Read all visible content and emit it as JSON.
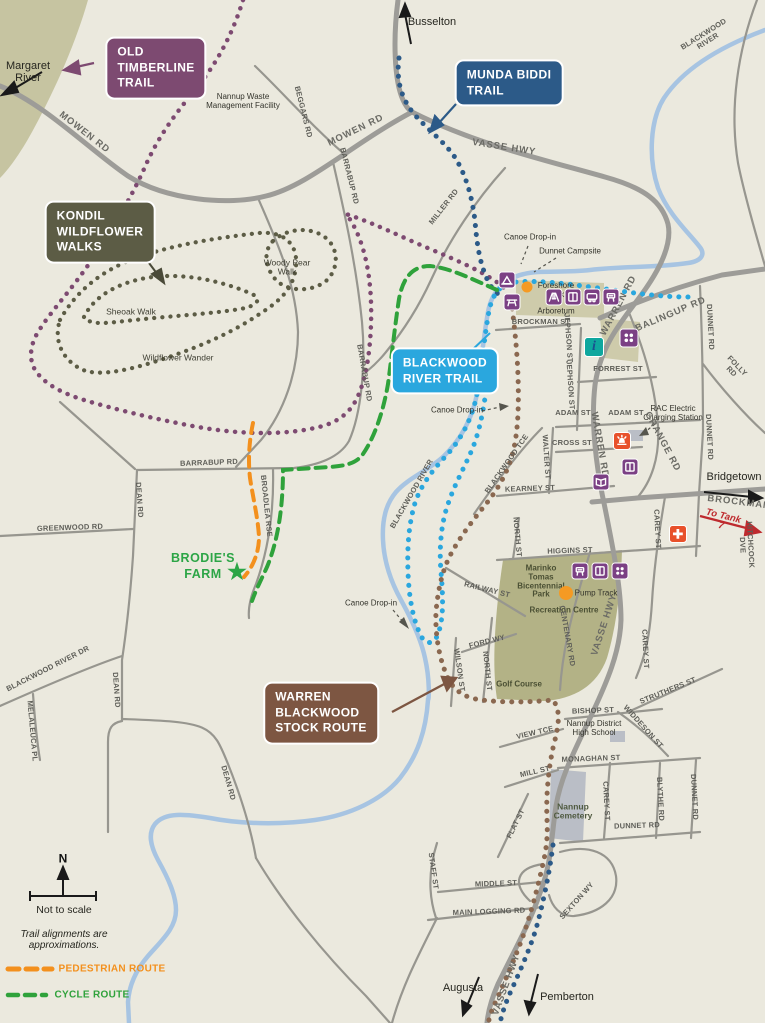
{
  "map_title": "Nannup trails map",
  "colors": {
    "background": "#EBE9DE",
    "forest": "#C6C4A1",
    "park": "#B3B286",
    "river": "#A7C4E2",
    "road": "#9D9C98",
    "old_timberline": "#7D4A71",
    "munda_biddi": "#2C5A88",
    "kondil": "#5C5C45",
    "blackwood_trail": "#2AA7DE",
    "stock_route": "#8A6850",
    "pedestrian": "#F3901D",
    "cycle": "#2FA23B",
    "facility": "#7B4084",
    "emergency": "#E8512B",
    "info": "#0FA79E",
    "marker": "#F59A23"
  },
  "callouts": [
    {
      "n": "old-timberline-trail-callout",
      "t": "OLD\nTIMBERLINE\nTRAIL",
      "x": 156,
      "y": 68,
      "bg": "#7D4A71"
    },
    {
      "n": "munda-biddi-trail-callout",
      "t": "MUNDA BIDDI\nTRAIL",
      "x": 509,
      "y": 83,
      "bg": "#2C5A88"
    },
    {
      "n": "kondil-wildflower-walks-callout",
      "t": "KONDIL\nWILDFLOWER\nWALKS",
      "x": 100,
      "y": 232,
      "bg": "#5C5C45"
    },
    {
      "n": "blackwood-river-trail-callout",
      "t": "BLACKWOOD\nRIVER TRAIL",
      "x": 445,
      "y": 371,
      "bg": "#2AA7DE"
    },
    {
      "n": "warren-blackwood-stock-route-callout",
      "t": "WARREN\nBLACKWOOD\nSTOCK ROUTE",
      "x": 321,
      "y": 713,
      "bg": "#7D5642"
    }
  ],
  "labels": [
    {
      "n": "margaret-river-label",
      "t": "Margaret\nRiver",
      "x": 28,
      "y": 72,
      "r": 0,
      "c": "pl"
    },
    {
      "n": "busselton-label",
      "t": "Busselton",
      "x": 432,
      "y": 22,
      "r": 0,
      "c": "pl"
    },
    {
      "n": "nannup-waste-management-facility-label",
      "t": "Nannup Waste\nManagement Facility",
      "x": 243,
      "y": 102,
      "r": 0,
      "c": "poi"
    },
    {
      "n": "beggars-rd-label",
      "t": "BEGGARS RD",
      "x": 303,
      "y": 112,
      "r": 76,
      "c": "rd"
    },
    {
      "n": "mowen-rd-west-label",
      "t": "MOWEN RD",
      "x": 84,
      "y": 133,
      "r": 38,
      "c": "rdl"
    },
    {
      "n": "mowen-rd-east-label",
      "t": "MOWEN RD",
      "x": 356,
      "y": 131,
      "r": -26,
      "c": "rdl"
    },
    {
      "n": "vasse-hwy-north-label",
      "t": "VASSE HWY",
      "x": 504,
      "y": 148,
      "r": 9,
      "c": "rdl"
    },
    {
      "n": "blackwood-river-north-label",
      "t": "BLACKWOOD RIVER",
      "x": 706,
      "y": 38,
      "r": -32,
      "c": "rd"
    },
    {
      "n": "miller-rd-label",
      "t": "MILLER RD",
      "x": 444,
      "y": 207,
      "r": -52,
      "c": "rd"
    },
    {
      "n": "barrabup-rd-north-label",
      "t": "BARRABUP RD",
      "x": 349,
      "y": 176,
      "r": 76,
      "c": "rd"
    },
    {
      "n": "barrabup-rd-mid-label",
      "t": "BARRABUP RD",
      "x": 364,
      "y": 373,
      "r": 80,
      "c": "rd"
    },
    {
      "n": "barrabup-rd-west-label",
      "t": "BARRABUP RD",
      "x": 209,
      "y": 463,
      "r": -2,
      "c": "rd"
    },
    {
      "n": "woody-pear-walk-label",
      "t": "Woody Pear\nWalk",
      "x": 287,
      "y": 268,
      "r": 0,
      "c": "walk"
    },
    {
      "n": "sheoak-walk-label",
      "t": "Sheoak Walk",
      "x": 131,
      "y": 312,
      "r": 0,
      "c": "walk"
    },
    {
      "n": "wildflower-wander-label",
      "t": "Wildflower Wander",
      "x": 178,
      "y": 358,
      "r": 0,
      "c": "walk"
    },
    {
      "n": "canoe-drop-in-north-label",
      "t": "Canoe Drop-in",
      "x": 530,
      "y": 238,
      "r": 0,
      "c": "poi"
    },
    {
      "n": "dunnet-campsite-label",
      "t": "Dunnet Campsite",
      "x": 570,
      "y": 252,
      "r": 0,
      "c": "poi"
    },
    {
      "n": "foreshore-park-label",
      "t": "Foreshore\nPark",
      "x": 556,
      "y": 291,
      "r": 0,
      "c": "poi"
    },
    {
      "n": "arboretum-label",
      "t": "Arboretum",
      "x": 556,
      "y": 312,
      "r": 0,
      "c": "poi"
    },
    {
      "n": "brockman-st-label",
      "t": "BROCKMAN ST",
      "x": 541,
      "y": 322,
      "r": 0,
      "c": "rd"
    },
    {
      "n": "jephson-st-north-label",
      "t": "JEPHSON ST",
      "x": 568,
      "y": 338,
      "r": 86,
      "c": "rd"
    },
    {
      "n": "jephson-st-south-label",
      "t": "JEPHSON ST",
      "x": 570,
      "y": 385,
      "r": 86,
      "c": "rd"
    },
    {
      "n": "warren-rd-north-label",
      "t": "WARREN RD",
      "x": 619,
      "y": 306,
      "r": -62,
      "c": "rdl"
    },
    {
      "n": "warren-rd-mid-label",
      "t": "WARREN RD",
      "x": 599,
      "y": 445,
      "r": 80,
      "c": "rdl"
    },
    {
      "n": "balingup-rd-label",
      "t": "BALINGUP RD",
      "x": 671,
      "y": 315,
      "r": -23,
      "c": "rdl"
    },
    {
      "n": "dunnet-rd-north-label",
      "t": "DUNNET RD",
      "x": 710,
      "y": 327,
      "r": 87,
      "c": "rd"
    },
    {
      "n": "dunnet-rd-mid-label",
      "t": "DUNNET RD",
      "x": 709,
      "y": 437,
      "r": 87,
      "c": "rd"
    },
    {
      "n": "folly-rd-label",
      "t": "FOLLY RD",
      "x": 734,
      "y": 369,
      "r": 46,
      "c": "rd"
    },
    {
      "n": "forrest-st-label",
      "t": "FORREST ST",
      "x": 618,
      "y": 369,
      "r": 0,
      "c": "rd"
    },
    {
      "n": "rac-charging-label",
      "t": "RAC Electric\nCharging Station",
      "x": 673,
      "y": 414,
      "r": 0,
      "c": "poi"
    },
    {
      "n": "adam-st-west-label",
      "t": "ADAM ST",
      "x": 573,
      "y": 413,
      "r": 0,
      "c": "rd"
    },
    {
      "n": "adam-st-east-label",
      "t": "ADAM ST",
      "x": 626,
      "y": 413,
      "r": 0,
      "c": "rd"
    },
    {
      "n": "cross-st-label",
      "t": "CROSS ST",
      "x": 572,
      "y": 443,
      "r": 0,
      "c": "rd"
    },
    {
      "n": "walter-st-label",
      "t": "WALTER ST",
      "x": 546,
      "y": 457,
      "r": 86,
      "c": "rd"
    },
    {
      "n": "grange-rd-label",
      "t": "GRANGE RD",
      "x": 662,
      "y": 442,
      "r": 62,
      "c": "rdl"
    },
    {
      "n": "bridgetown-label",
      "t": "Bridgetown",
      "x": 734,
      "y": 477,
      "r": 0,
      "c": "pl"
    },
    {
      "n": "brockman-east-label",
      "t": "BROCKMAN",
      "x": 739,
      "y": 503,
      "r": 7,
      "c": "rdl"
    },
    {
      "n": "to-tank-7-label",
      "t": "To Tank 7",
      "x": 722,
      "y": 522,
      "r": 14,
      "c": "tank"
    },
    {
      "n": "hitchcock-dve-label",
      "t": "HITCHCOCK DVE",
      "x": 746,
      "y": 545,
      "r": 87,
      "c": "rd"
    },
    {
      "n": "kearney-st-label",
      "t": "KEARNEY ST",
      "x": 530,
      "y": 489,
      "r": -2,
      "c": "rd"
    },
    {
      "n": "blackwood-tce-label",
      "t": "BLACKWOOD TCE",
      "x": 507,
      "y": 464,
      "r": -55,
      "c": "rd"
    },
    {
      "n": "blackwood-river-mid-label",
      "t": "BLACKWOOD RIVER",
      "x": 412,
      "y": 494,
      "r": -60,
      "c": "rd"
    },
    {
      "n": "canoe-drop-in-mid-label",
      "t": "Canoe Drop-in",
      "x": 457,
      "y": 411,
      "r": 0,
      "c": "poi"
    },
    {
      "n": "higgins-st-label",
      "t": "HIGGINS ST",
      "x": 570,
      "y": 551,
      "r": -2,
      "c": "rd"
    },
    {
      "n": "north-st-north-label",
      "t": "NORTH ST",
      "x": 517,
      "y": 537,
      "r": 85,
      "c": "rd"
    },
    {
      "n": "marinko-park-label",
      "t": "Marinko\nTomas\nBicentennial\nPark",
      "x": 541,
      "y": 582,
      "r": 0,
      "c": "po"
    },
    {
      "n": "pump-track-label",
      "t": "Pump Track",
      "x": 596,
      "y": 594,
      "r": 0,
      "c": "poi"
    },
    {
      "n": "recreation-centre-label",
      "t": "Recreation Centre",
      "x": 564,
      "y": 611,
      "r": 0,
      "c": "po"
    },
    {
      "n": "centenary-rd-label",
      "t": "CENTENARY RD",
      "x": 567,
      "y": 636,
      "r": 80,
      "c": "rd"
    },
    {
      "n": "vasse-hwy-mid-label",
      "t": "VASSE HWY",
      "x": 605,
      "y": 625,
      "r": -72,
      "c": "rdl"
    },
    {
      "n": "ford-wy-label",
      "t": "FORD WY",
      "x": 487,
      "y": 642,
      "r": -14,
      "c": "rd"
    },
    {
      "n": "wilson-st-label",
      "t": "WILSON ST",
      "x": 459,
      "y": 670,
      "r": 82,
      "c": "rd"
    },
    {
      "n": "north-st-south-label",
      "t": "NORTH ST",
      "x": 487,
      "y": 671,
      "r": 84,
      "c": "rd"
    },
    {
      "n": "railway-st-label",
      "t": "RAILWAY ST",
      "x": 487,
      "y": 590,
      "r": 14,
      "c": "rd"
    },
    {
      "n": "carey-st-north-label",
      "t": "CAREY ST",
      "x": 657,
      "y": 529,
      "r": 87,
      "c": "rd"
    },
    {
      "n": "carey-st-mid-label",
      "t": "CAREY ST",
      "x": 645,
      "y": 649,
      "r": 87,
      "c": "rd"
    },
    {
      "n": "golf-course-label",
      "t": "Golf Course",
      "x": 519,
      "y": 685,
      "r": 0,
      "c": "po"
    },
    {
      "n": "struthers-st-label",
      "t": "STRUTHERS ST",
      "x": 668,
      "y": 691,
      "r": -22,
      "c": "rd"
    },
    {
      "n": "bishop-st-label",
      "t": "BISHOP ST",
      "x": 593,
      "y": 711,
      "r": -2,
      "c": "rd"
    },
    {
      "n": "widdeson-st-label",
      "t": "WIDDESON ST",
      "x": 643,
      "y": 727,
      "r": 48,
      "c": "rd"
    },
    {
      "n": "nannup-high-school-label",
      "t": "Nannup District\nHigh School",
      "x": 594,
      "y": 729,
      "r": 0,
      "c": "poi"
    },
    {
      "n": "view-tce-label",
      "t": "VIEW TCE",
      "x": 535,
      "y": 733,
      "r": -13,
      "c": "rd"
    },
    {
      "n": "monaghan-st-label",
      "t": "MONAGHAN ST",
      "x": 591,
      "y": 759,
      "r": -2,
      "c": "rd"
    },
    {
      "n": "mill-st-label",
      "t": "MILL ST",
      "x": 535,
      "y": 772,
      "r": -13,
      "c": "rd"
    },
    {
      "n": "carey-st-south-label",
      "t": "CAREY ST",
      "x": 606,
      "y": 801,
      "r": 87,
      "c": "rd"
    },
    {
      "n": "blythe-rd-label",
      "t": "BLYTHE RD",
      "x": 660,
      "y": 799,
      "r": 87,
      "c": "rd"
    },
    {
      "n": "dunnet-rd-south-label",
      "t": "DUNNET RD",
      "x": 694,
      "y": 797,
      "r": 87,
      "c": "rd"
    },
    {
      "n": "nannup-cemetery-label",
      "t": "Nannup\nCemetery",
      "x": 573,
      "y": 812,
      "r": 0,
      "c": "cem"
    },
    {
      "n": "dunnet-rd-bottom-label",
      "t": "DUNNET RD",
      "x": 637,
      "y": 826,
      "r": -2,
      "c": "rd"
    },
    {
      "n": "flat-st-label",
      "t": "FLAT ST",
      "x": 516,
      "y": 824,
      "r": -64,
      "c": "rd"
    },
    {
      "n": "staff-st-label",
      "t": "STAFF ST",
      "x": 433,
      "y": 871,
      "r": 82,
      "c": "rd"
    },
    {
      "n": "middle-st-label",
      "t": "MIDDLE ST",
      "x": 496,
      "y": 884,
      "r": -2,
      "c": "rd"
    },
    {
      "n": "main-logging-rd-label",
      "t": "MAIN LOGGING RD",
      "x": 489,
      "y": 912,
      "r": -2,
      "c": "rd"
    },
    {
      "n": "sexton-wy-label",
      "t": "SEXTON WY",
      "x": 577,
      "y": 901,
      "r": -48,
      "c": "rd"
    },
    {
      "n": "vasse-hwy-south-label",
      "t": "VASSE HWY",
      "x": 507,
      "y": 985,
      "r": -70,
      "c": "rdl"
    },
    {
      "n": "augusta-label",
      "t": "Augusta",
      "x": 463,
      "y": 988,
      "r": 0,
      "c": "pl"
    },
    {
      "n": "pemberton-label",
      "t": "Pemberton",
      "x": 567,
      "y": 997,
      "r": 0,
      "c": "pl"
    },
    {
      "n": "dean-rd-north-label",
      "t": "DEAN RD",
      "x": 139,
      "y": 500,
      "r": 86,
      "c": "rd"
    },
    {
      "n": "dean-rd-mid-label",
      "t": "DEAN RD",
      "x": 116,
      "y": 690,
      "r": 86,
      "c": "rd"
    },
    {
      "n": "dean-rd-south-label",
      "t": "DEAN RD",
      "x": 228,
      "y": 783,
      "r": 74,
      "c": "rd"
    },
    {
      "n": "greenwood-rd-label",
      "t": "GREENWOOD RD",
      "x": 70,
      "y": 528,
      "r": -2,
      "c": "rd"
    },
    {
      "n": "blackwood-river-dr-label",
      "t": "BLACKWOOD RIVER DR",
      "x": 48,
      "y": 669,
      "r": -27,
      "c": "rd"
    },
    {
      "n": "melaleuca-pl-label",
      "t": "MELALEUCA PL",
      "x": 32,
      "y": 731,
      "r": 85,
      "c": "rd"
    },
    {
      "n": "broadlea-rse-label",
      "t": "BROADLEA RSE",
      "x": 266,
      "y": 506,
      "r": 84,
      "c": "rd"
    },
    {
      "n": "brodies-farm-label",
      "t": "BRODIE'S\nFARM",
      "x": 203,
      "y": 566,
      "r": 0,
      "c": "farm"
    },
    {
      "n": "canoe-drop-in-south-label",
      "t": "Canoe Drop-in",
      "x": 371,
      "y": 604,
      "r": 0,
      "c": "poi"
    },
    {
      "n": "compass-n-label",
      "t": "N",
      "x": 63,
      "y": 859,
      "r": 0,
      "c": "nN"
    },
    {
      "n": "not-to-scale-label",
      "t": "Not to scale",
      "x": 64,
      "y": 911,
      "r": 0,
      "c": "nt"
    },
    {
      "n": "approximation-note-label",
      "t": "Trail alignments are\napproximations.",
      "x": 64,
      "y": 940,
      "r": 0,
      "c": "ni"
    },
    {
      "n": "legend-pedestrian-label",
      "t": "PEDESTRIAN ROUTE",
      "x": 112,
      "y": 969,
      "r": 0,
      "c": "lo"
    },
    {
      "n": "legend-cycle-label",
      "t": "CYCLE ROUTE",
      "x": 92,
      "y": 995,
      "r": 0,
      "c": "lg"
    }
  ],
  "icons": [
    {
      "n": "campsite-icon",
      "g": "tent",
      "x": 507,
      "y": 280,
      "bg": "#7B4084",
      "s": 17
    },
    {
      "n": "picnic-icon",
      "g": "table",
      "x": 512,
      "y": 302,
      "bg": "#7B4084",
      "s": 17
    },
    {
      "n": "playground-swing-icon",
      "g": "frame",
      "x": 554,
      "y": 297,
      "bg": "#7B4084",
      "s": 17
    },
    {
      "n": "toilets-icon",
      "g": "door",
      "x": 573,
      "y": 297,
      "bg": "#7B4084",
      "s": 17
    },
    {
      "n": "caravan-icon",
      "g": "van",
      "x": 592,
      "y": 297,
      "bg": "#7B4084",
      "s": 17
    },
    {
      "n": "bbq-icon",
      "g": "grill",
      "x": 611,
      "y": 297,
      "bg": "#7B4084",
      "s": 17
    },
    {
      "n": "playground-icon",
      "g": "dots4",
      "x": 629,
      "y": 338,
      "bg": "#7B4084",
      "s": 19
    },
    {
      "n": "toilets-icon-2",
      "g": "door",
      "x": 630,
      "y": 467,
      "bg": "#7B4084",
      "s": 17
    },
    {
      "n": "gallery-icon",
      "g": "book",
      "x": 601,
      "y": 482,
      "bg": "#7B4084",
      "s": 17
    },
    {
      "n": "bbq-icon-2",
      "g": "grill",
      "x": 580,
      "y": 571,
      "bg": "#7B4084",
      "s": 17
    },
    {
      "n": "toilets-icon-3",
      "g": "door",
      "x": 600,
      "y": 571,
      "bg": "#7B4084",
      "s": 17
    },
    {
      "n": "playground-icon-2",
      "g": "dots4",
      "x": 620,
      "y": 571,
      "bg": "#7B4084",
      "s": 17
    },
    {
      "n": "emergency-services-icon",
      "g": "bell",
      "x": 622,
      "y": 441,
      "bg": "#E8512B",
      "s": 18
    },
    {
      "n": "hospital-icon",
      "g": "cross",
      "x": 678,
      "y": 534,
      "bg": "#E8512B",
      "s": 18
    },
    {
      "n": "visitor-info-icon",
      "g": "i",
      "x": 594,
      "y": 347,
      "bg": "#0FA79E",
      "s": 20,
      "char": "i"
    },
    {
      "n": "foreshore-park-marker",
      "g": "circle",
      "x": 527,
      "y": 287,
      "bg": "#F59A23",
      "s": 11
    },
    {
      "n": "pump-track-marker",
      "g": "circle",
      "x": 566,
      "y": 593,
      "bg": "#F59A23",
      "s": 14
    },
    {
      "n": "brodies-farm-star",
      "g": "star",
      "x": 237,
      "y": 572,
      "bg": "none",
      "s": 22,
      "char": "★"
    }
  ]
}
